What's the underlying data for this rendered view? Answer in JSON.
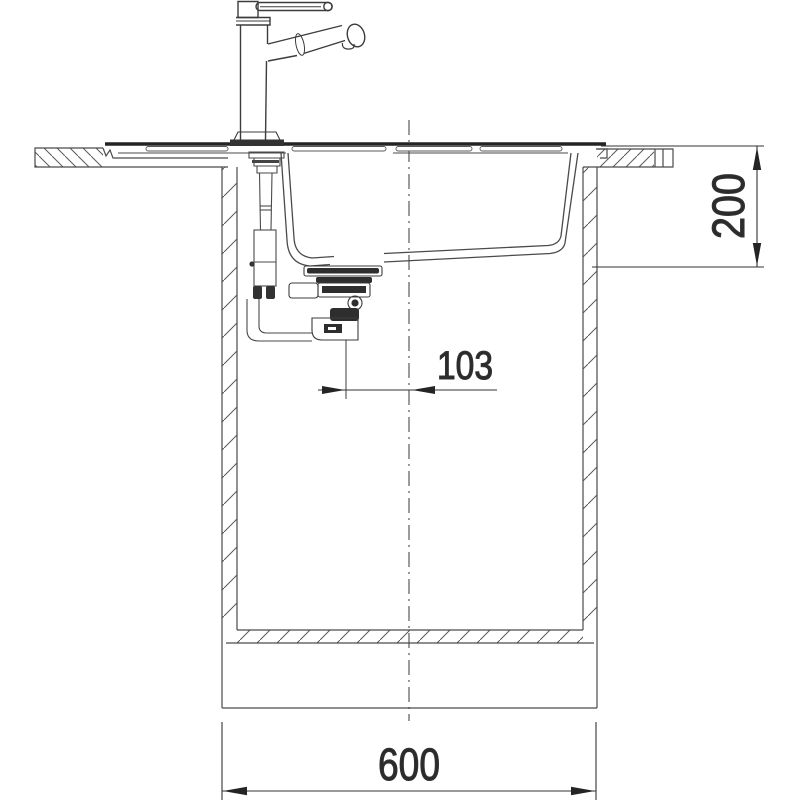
{
  "page": {
    "background": "#ffffff",
    "line_color": "#4a4a4a",
    "thick_line_color": "#242424",
    "dim_color": "#333333"
  },
  "dimensions": {
    "depth_label": "200",
    "drain_offset_label": "103",
    "width_label": "600"
  }
}
